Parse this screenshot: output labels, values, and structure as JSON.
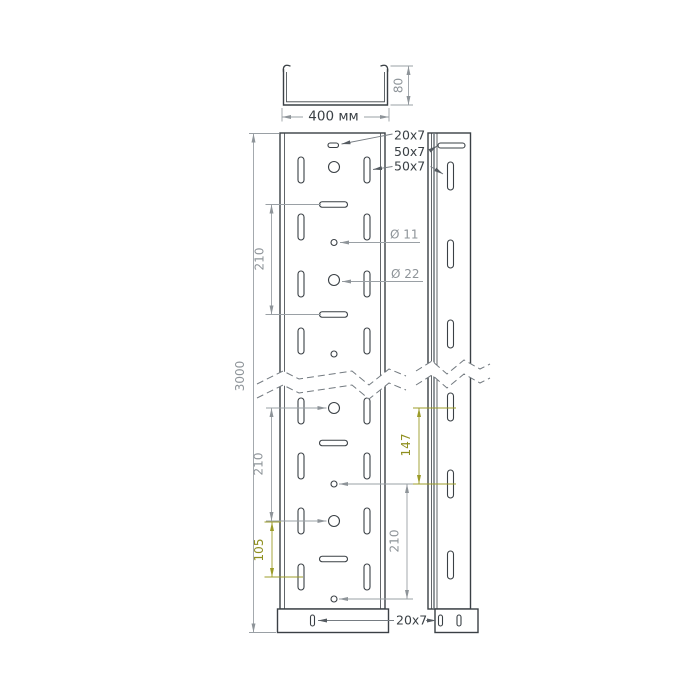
{
  "page": {
    "background": "#ffffff"
  },
  "drawing": {
    "colors": {
      "outline": "#3a4045",
      "dimension": "#9aa0a5",
      "dimension_text": "#8e9499",
      "accent": "#9c9c28",
      "accent_text": "#8f8f1f",
      "label_text": "#3a4045"
    },
    "cross_section": {
      "width": "400 мм",
      "height": "80"
    },
    "dimensions": {
      "total_length": "3000",
      "hole_pitch_upper": "210",
      "hole_pitch_lower_left": "210",
      "hole_pitch_lower_right": "210",
      "hole_offset_bottom": "105",
      "side_slot_pitch": "147"
    },
    "labels": {
      "slot_top": "20x7",
      "slot_flange": "50x7",
      "slot_side": "50x7",
      "slot_bottom": "20x7",
      "hole_small": "Ø 11",
      "hole_large": "Ø 22"
    }
  }
}
